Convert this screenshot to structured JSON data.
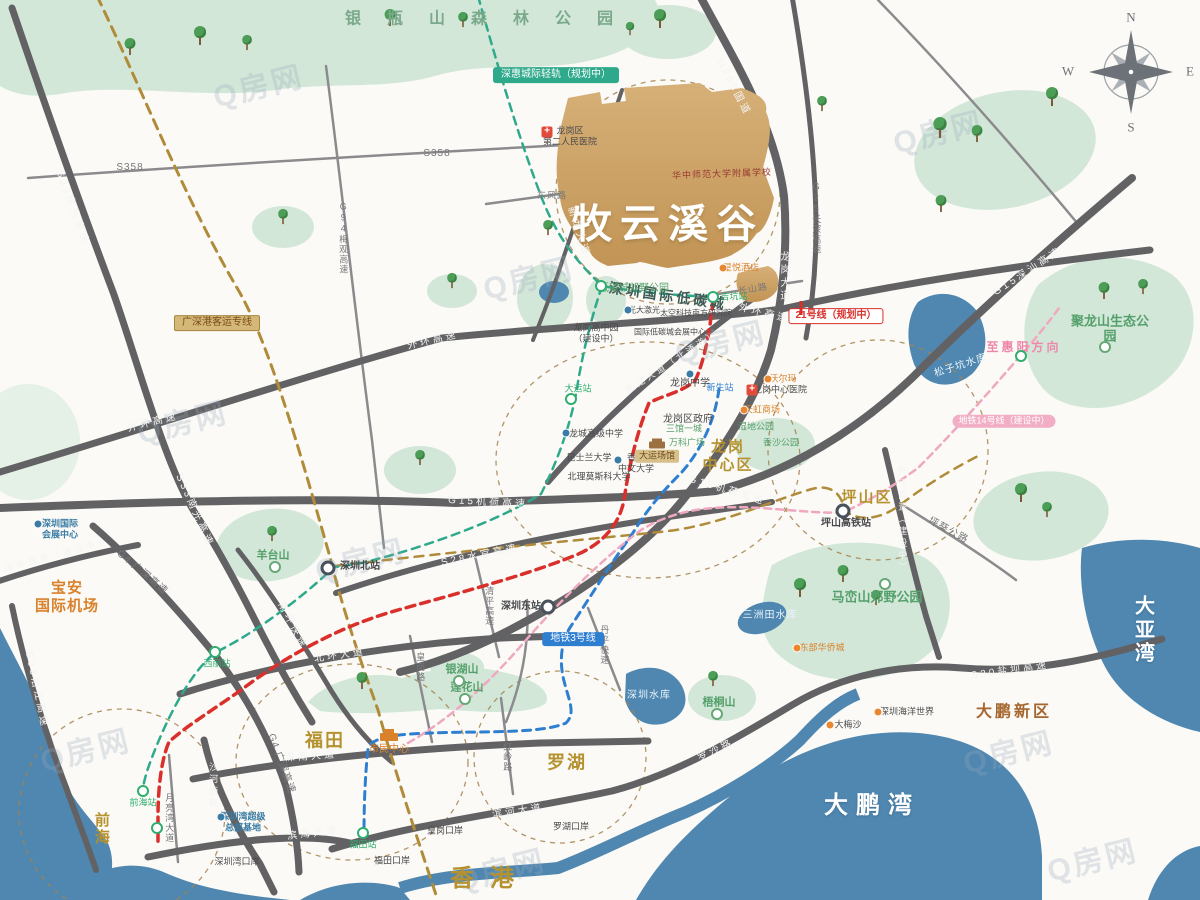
{
  "map_title": "牧云溪谷 区位示意图",
  "watermark": {
    "text": "Q房网",
    "positions": [
      [
        85,
        748
      ],
      [
        258,
        84
      ],
      [
        528,
        276
      ],
      [
        720,
        340
      ],
      [
        1008,
        750
      ],
      [
        1092,
        858
      ],
      [
        500,
        868
      ],
      [
        182,
        420
      ],
      [
        938,
        130
      ],
      [
        360,
        558
      ]
    ]
  },
  "colors": {
    "park": "#d3e7d9",
    "water": "#4f87b0",
    "road": "#626264",
    "project_tan": "#cfa76d",
    "gold_line": "#b08c3a",
    "teal_line": "#2fa98c",
    "red_line": "#d9302c",
    "blue_line": "#2f7fd1",
    "pink_line": "#f0a8c0"
  },
  "trees": [
    [
      200,
      45,
      1
    ],
    [
      247,
      52,
      0.8
    ],
    [
      390,
      27,
      0.9
    ],
    [
      463,
      29,
      0.8
    ],
    [
      660,
      28,
      1
    ],
    [
      630,
      38,
      0.7
    ],
    [
      130,
      56,
      0.9
    ],
    [
      822,
      113,
      0.8
    ],
    [
      940,
      137,
      1.1
    ],
    [
      977,
      143,
      0.9
    ],
    [
      1052,
      106,
      1
    ],
    [
      941,
      213,
      0.9
    ],
    [
      1104,
      300,
      0.9
    ],
    [
      1143,
      296,
      0.8
    ],
    [
      283,
      226,
      0.8
    ],
    [
      548,
      237,
      0.8
    ],
    [
      452,
      290,
      0.8
    ],
    [
      272,
      543,
      0.8
    ],
    [
      420,
      467,
      0.8
    ],
    [
      1021,
      502,
      1
    ],
    [
      1047,
      519,
      0.8
    ],
    [
      800,
      597,
      1
    ],
    [
      843,
      583,
      0.9
    ],
    [
      876,
      607,
      0.8
    ],
    [
      362,
      690,
      0.9
    ],
    [
      713,
      688,
      0.8
    ]
  ],
  "labels": [
    {
      "t": "forest",
      "x": 492,
      "y": 20,
      "text": "银瓶山森林公园"
    },
    {
      "t": "logo-script",
      "x": 722,
      "y": 174,
      "r": -2,
      "text": "华中师范大学附属学校"
    },
    {
      "t": "logo-name",
      "x": 668,
      "y": 225,
      "text": "牧云溪谷"
    },
    {
      "t": "lowcarbon",
      "x": 668,
      "y": 296,
      "r": 8,
      "text": "深圳国际低碳城"
    },
    {
      "t": "region-gold",
      "x": 728,
      "y": 456,
      "fs": 15,
      "text": "龙岗\n中心区"
    },
    {
      "t": "region-gold",
      "x": 867,
      "y": 498,
      "fs": 15,
      "text": "坪山区"
    },
    {
      "t": "region-gold",
      "x": 325,
      "y": 741,
      "fs": 18,
      "text": "福田"
    },
    {
      "t": "region-gold",
      "x": 567,
      "y": 763,
      "fs": 18,
      "text": "罗湖"
    },
    {
      "t": "region-gold hk",
      "x": 490,
      "y": 879,
      "fs": 24,
      "text": "香港"
    },
    {
      "t": "region-gold",
      "x": 101,
      "y": 829,
      "fs": 15,
      "v": 1,
      "text": "前海"
    },
    {
      "t": "region-white",
      "x": 872,
      "y": 806,
      "fs": 24,
      "text": "大鹏湾"
    },
    {
      "t": "region-white",
      "x": 1149,
      "y": 631,
      "fs": 20,
      "text": "大亚湾"
    },
    {
      "t": "region-brown",
      "x": 1014,
      "y": 713,
      "fs": 16,
      "text": "大鹏新区"
    },
    {
      "t": "region-orange",
      "x": 67,
      "y": 597,
      "fs": 15,
      "text": "宝安\n国际机场"
    },
    {
      "t": "i-plane",
      "x": 70,
      "y": 634
    },
    {
      "t": "park",
      "x": 1110,
      "y": 329,
      "fs": 13,
      "text": "聚龙山生态公园"
    },
    {
      "t": "i-park",
      "x": 1105,
      "y": 347
    },
    {
      "t": "park",
      "x": 877,
      "y": 597,
      "fs": 13,
      "text": "马峦山郊野公园"
    },
    {
      "t": "i-park",
      "x": 885,
      "y": 584
    },
    {
      "t": "park-sm",
      "x": 273,
      "y": 556,
      "text": "羊台山"
    },
    {
      "t": "i-park",
      "x": 275,
      "y": 567
    },
    {
      "t": "park-sm",
      "x": 467,
      "y": 688,
      "text": "莲花山"
    },
    {
      "t": "i-park",
      "x": 465,
      "y": 699
    },
    {
      "t": "park-sm",
      "x": 462,
      "y": 670,
      "text": "银湖山"
    },
    {
      "t": "i-park",
      "x": 459,
      "y": 681
    },
    {
      "t": "park-sm",
      "x": 719,
      "y": 703,
      "text": "梧桐山"
    },
    {
      "t": "i-park",
      "x": 717,
      "y": 714
    },
    {
      "t": "poi-g",
      "x": 634,
      "y": 289,
      "text": "低碳城郊野公园"
    },
    {
      "t": "i-st-g",
      "x": 601,
      "y": 286
    },
    {
      "t": "water-t",
      "x": 961,
      "y": 366,
      "r": -18,
      "text": "松子坑水库"
    },
    {
      "t": "water-t",
      "x": 770,
      "y": 616,
      "text": "三洲田水库"
    },
    {
      "t": "water-t",
      "x": 649,
      "y": 696,
      "text": "深圳水库"
    },
    {
      "t": "rd-w",
      "x": 153,
      "y": 423,
      "r": -14,
      "text": "外环高速"
    },
    {
      "t": "rd-w",
      "x": 433,
      "y": 341,
      "r": -13,
      "text": "外环高速"
    },
    {
      "t": "rd-w",
      "x": 764,
      "y": 314,
      "r": 14,
      "text": "外环高速"
    },
    {
      "t": "rd-w",
      "x": 902,
      "y": 520,
      "v": 1,
      "fs": 9,
      "text": "外环高速（建设中）"
    },
    {
      "t": "rd-w",
      "x": 72,
      "y": 208,
      "r": 70,
      "text": "S33南光高速"
    },
    {
      "t": "rd-w",
      "x": 194,
      "y": 511,
      "r": 66,
      "text": "S33南光高速"
    },
    {
      "t": "rd-w",
      "x": 36,
      "y": 690,
      "r": 78,
      "text": "S33沿江高速"
    },
    {
      "t": "rd-w",
      "x": 57,
      "y": 555,
      "r": -15,
      "fs": 9,
      "text": "深中通道（建设中）"
    },
    {
      "t": "rd-d",
      "x": 142,
      "y": 573,
      "r": 40,
      "text": "G4 广深高速"
    },
    {
      "t": "rd-d",
      "x": 281,
      "y": 764,
      "r": 70,
      "text": "G4 广深高速"
    },
    {
      "t": "rd-w",
      "x": 488,
      "y": 503,
      "r": 3,
      "text": "G15机荷高速"
    },
    {
      "t": "rd-w",
      "x": 727,
      "y": 491,
      "r": 17,
      "text": "G15机荷高速"
    },
    {
      "t": "rd-w",
      "x": 1028,
      "y": 272,
      "r": -33,
      "text": "G15深汕高速"
    },
    {
      "t": "rd-w",
      "x": 480,
      "y": 556,
      "r": -11,
      "text": "S28水官高速"
    },
    {
      "t": "rd-w",
      "x": 292,
      "y": 626,
      "r": 62,
      "text": "南坪快速"
    },
    {
      "t": "rd-w",
      "x": 340,
      "y": 656,
      "r": -8,
      "text": "北环大道"
    },
    {
      "t": "rd-w",
      "x": 311,
      "y": 757,
      "r": -4,
      "text": "深南大道"
    },
    {
      "t": "rd-w",
      "x": 518,
      "y": 812,
      "r": -8,
      "text": "滨河大道"
    },
    {
      "t": "rd-w",
      "x": 313,
      "y": 834,
      "r": -7,
      "text": "滨海大道"
    },
    {
      "t": "rd-w",
      "x": 716,
      "y": 751,
      "r": -25,
      "text": "罗沙路"
    },
    {
      "t": "rd-w",
      "x": 1010,
      "y": 671,
      "r": -8,
      "text": "S30盐坝高速"
    },
    {
      "t": "rd-w",
      "x": 672,
      "y": 362,
      "r": -33,
      "fs": 9,
      "text": "盐龙大道（北通道）"
    },
    {
      "t": "rd-w",
      "x": 783,
      "y": 277,
      "v": 1,
      "text": "龙岗大道"
    },
    {
      "t": "rd-w",
      "x": 578,
      "y": 232,
      "r": 72,
      "text": "新龙大道"
    },
    {
      "t": "rd-w",
      "x": 733,
      "y": 88,
      "r": 62,
      "text": "G205国道"
    },
    {
      "t": "rd-d",
      "x": 816,
      "y": 218,
      "v": 1,
      "fs": 9,
      "text": "G25长深高速"
    },
    {
      "t": "rd-d",
      "x": 753,
      "y": 289,
      "r": -9,
      "fs": 9,
      "text": "长山路"
    },
    {
      "t": "rd-d",
      "x": 948,
      "y": 531,
      "r": 28,
      "text": "坪葵公路"
    },
    {
      "t": "rd-d",
      "x": 169,
      "y": 818,
      "v": 1,
      "fs": 9,
      "text": "月亮湾大道"
    },
    {
      "t": "rd-w",
      "x": 213,
      "y": 786,
      "v": 1,
      "fs": 9,
      "text": "沙河西路"
    },
    {
      "t": "rd-d",
      "x": 507,
      "y": 757,
      "v": 1,
      "fs": 9,
      "text": "红岭路"
    },
    {
      "t": "rd-d",
      "x": 420,
      "y": 667,
      "v": 1,
      "fs": 9,
      "text": "皇岗路"
    },
    {
      "t": "rd-d",
      "x": 489,
      "y": 606,
      "v": 1,
      "fs": 9,
      "text": "清平高速"
    },
    {
      "t": "rd-d",
      "x": 604,
      "y": 645,
      "v": 1,
      "fs": 9,
      "text": "丹平快速"
    },
    {
      "t": "rd-d",
      "x": 130,
      "y": 168,
      "text": "S358"
    },
    {
      "t": "rd-d",
      "x": 437,
      "y": 154,
      "text": "S358"
    },
    {
      "t": "rd-d",
      "x": 343,
      "y": 238,
      "v": 1,
      "fs": 9,
      "text": "G94梅观高速"
    },
    {
      "t": "rd-d",
      "x": 552,
      "y": 196,
      "fs": 9,
      "text": "东风路"
    },
    {
      "t": "badge-teal",
      "x": 556,
      "y": 75,
      "text": "深惠城际轻轨（规划中）"
    },
    {
      "t": "badge-gold",
      "x": 217,
      "y": 323,
      "text": "广深港客运专线"
    },
    {
      "t": "badge-red",
      "x": 836,
      "y": 316,
      "text": "21号线（规划中）"
    },
    {
      "t": "i-tick",
      "x": 801,
      "y": 308
    },
    {
      "t": "badge-blue",
      "x": 573,
      "y": 639,
      "text": "地铁3号线"
    },
    {
      "t": "badge-pink",
      "x": 1004,
      "y": 421,
      "text": "地铁14号线（建设中）"
    },
    {
      "t": "pink-t",
      "x": 1024,
      "y": 347,
      "text": "至惠阳方向"
    },
    {
      "t": "i-st-d",
      "x": 328,
      "y": 568
    },
    {
      "t": "st-d",
      "x": 360,
      "y": 567,
      "text": "深圳北站"
    },
    {
      "t": "st-d",
      "x": 521,
      "y": 607,
      "text": "深圳东站"
    },
    {
      "t": "i-st-d",
      "x": 548,
      "y": 607
    },
    {
      "t": "i-st-d",
      "x": 843,
      "y": 511
    },
    {
      "t": "st-d",
      "x": 846,
      "y": 524,
      "text": "坪山高铁站"
    },
    {
      "t": "i-st-g",
      "x": 143,
      "y": 791
    },
    {
      "t": "st-g",
      "x": 143,
      "y": 803,
      "text": "前海站"
    },
    {
      "t": "i-st-g",
      "x": 157,
      "y": 828
    },
    {
      "t": "i-st-g",
      "x": 363,
      "y": 833
    },
    {
      "t": "st-g",
      "x": 363,
      "y": 845,
      "text": "福田站"
    },
    {
      "t": "i-st-g",
      "x": 215,
      "y": 652
    },
    {
      "t": "st-g",
      "x": 217,
      "y": 664,
      "text": "西丽站"
    },
    {
      "t": "i-st-g",
      "x": 713,
      "y": 297
    },
    {
      "t": "st-g",
      "x": 734,
      "y": 297,
      "text": "吉坑站"
    },
    {
      "t": "i-st-g",
      "x": 571,
      "y": 399
    },
    {
      "t": "st-g",
      "x": 578,
      "y": 389,
      "text": "大运站"
    },
    {
      "t": "i-st-g",
      "x": 1021,
      "y": 356
    },
    {
      "t": "st-b",
      "x": 720,
      "y": 388,
      "text": "新生站"
    },
    {
      "t": "poi-b",
      "x": 60,
      "y": 529,
      "fs": 9,
      "text": "深圳国际\n会展中心"
    },
    {
      "t": "i-dot-b",
      "x": 38,
      "y": 524
    },
    {
      "t": "poi-b",
      "x": 243,
      "y": 822,
      "fs": 9,
      "text": "深圳湾超级\n总部基地"
    },
    {
      "t": "i-dot-b",
      "x": 221,
      "y": 817
    },
    {
      "t": "poi-o",
      "x": 389,
      "y": 750,
      "text": "市民中心"
    },
    {
      "t": "i-bldg-o",
      "x": 389,
      "y": 737
    },
    {
      "t": "poi",
      "x": 688,
      "y": 420,
      "text": "龙岗区政府"
    },
    {
      "t": "i-star",
      "x": 688,
      "y": 408
    },
    {
      "t": "poi",
      "x": 690,
      "y": 384,
      "text": "龙岗中学"
    },
    {
      "t": "i-dot-b",
      "x": 690,
      "y": 374
    },
    {
      "t": "poi",
      "x": 596,
      "y": 434,
      "fs": 9,
      "text": "龙城高级中学"
    },
    {
      "t": "i-dot-b",
      "x": 566,
      "y": 433
    },
    {
      "t": "poi",
      "x": 636,
      "y": 463,
      "fs": 9,
      "text": "香港\n中文大学"
    },
    {
      "t": "i-dot-b",
      "x": 618,
      "y": 460
    },
    {
      "t": "poi",
      "x": 599,
      "y": 477,
      "fs": 9,
      "text": "北理莫斯科大学"
    },
    {
      "t": "poi",
      "x": 589,
      "y": 458,
      "fs": 9,
      "text": "昆士兰大学"
    },
    {
      "t": "poi",
      "x": 596,
      "y": 333,
      "fs": 9,
      "text": "龙岗高中园\n（建设中）"
    },
    {
      "t": "poi",
      "x": 570,
      "y": 136,
      "fs": 9,
      "text": "龙岗区\n第二人民医院"
    },
    {
      "t": "i-cross",
      "x": 547,
      "y": 132
    },
    {
      "t": "poi",
      "x": 780,
      "y": 390,
      "fs": 9,
      "text": "龙岗中心医院"
    },
    {
      "t": "i-cross",
      "x": 752,
      "y": 390
    },
    {
      "t": "poi-g",
      "x": 684,
      "y": 429,
      "fs": 9,
      "text": "三馆一城"
    },
    {
      "t": "poi-g",
      "x": 687,
      "y": 443,
      "fs": 9,
      "text": "万科广场"
    },
    {
      "t": "poi-o",
      "x": 783,
      "y": 379,
      "fs": 9,
      "text": "沃尔玛"
    },
    {
      "t": "i-dot-o",
      "x": 768,
      "y": 379
    },
    {
      "t": "poi-o",
      "x": 762,
      "y": 410,
      "fs": 9,
      "text": "天虹商场"
    },
    {
      "t": "i-dot-o",
      "x": 744,
      "y": 410
    },
    {
      "t": "poi-g",
      "x": 756,
      "y": 427,
      "fs": 9,
      "text": "湿地公园"
    },
    {
      "t": "poi-g",
      "x": 781,
      "y": 443,
      "fs": 9,
      "text": "香沙公园"
    },
    {
      "t": "tag-tan",
      "x": 657,
      "y": 456,
      "text": "大运场馆"
    },
    {
      "t": "i-bldg-br",
      "x": 657,
      "y": 445
    },
    {
      "t": "poi-o",
      "x": 741,
      "y": 268,
      "fs": 9,
      "text": "星悦酒店"
    },
    {
      "t": "i-dot-o",
      "x": 723,
      "y": 268
    },
    {
      "t": "poi",
      "x": 907,
      "y": 712,
      "fs": 9,
      "text": "深圳海洋世界"
    },
    {
      "t": "i-dot-o",
      "x": 878,
      "y": 712
    },
    {
      "t": "poi",
      "x": 848,
      "y": 725,
      "fs": 9,
      "text": "大梅沙"
    },
    {
      "t": "i-dot-o",
      "x": 830,
      "y": 725
    },
    {
      "t": "poi-o",
      "x": 822,
      "y": 648,
      "fs": 9,
      "text": "东部华侨城"
    },
    {
      "t": "i-dot-o",
      "x": 797,
      "y": 648
    },
    {
      "t": "poi",
      "x": 571,
      "y": 827,
      "fs": 9,
      "text": "罗湖口岸"
    },
    {
      "t": "i-star",
      "x": 591,
      "y": 826
    },
    {
      "t": "poi",
      "x": 445,
      "y": 831,
      "fs": 9,
      "text": "皇岗口岸"
    },
    {
      "t": "i-star",
      "x": 442,
      "y": 841
    },
    {
      "t": "poi",
      "x": 392,
      "y": 861,
      "fs": 9,
      "text": "福田口岸"
    },
    {
      "t": "i-star",
      "x": 411,
      "y": 861
    },
    {
      "t": "poi",
      "x": 237,
      "y": 862,
      "fs": 9,
      "text": "深圳湾口岸"
    },
    {
      "t": "i-star",
      "x": 216,
      "y": 862
    },
    {
      "t": "poi",
      "x": 644,
      "y": 310,
      "fs": 8,
      "text": "光大激光"
    },
    {
      "t": "i-dot-b",
      "x": 628,
      "y": 310
    },
    {
      "t": "poi",
      "x": 696,
      "y": 313,
      "fs": 8,
      "text": "太空科技南方研究院"
    },
    {
      "t": "poi",
      "x": 670,
      "y": 332,
      "fs": 8,
      "text": "国际低碳城会展中心"
    },
    {
      "t": "compass",
      "x": 1131,
      "y": 17,
      "text": "N"
    },
    {
      "t": "compass",
      "x": 1190,
      "y": 71,
      "text": "E"
    },
    {
      "t": "compass",
      "x": 1131,
      "y": 127,
      "text": "S"
    },
    {
      "t": "compass",
      "x": 1068,
      "y": 71,
      "text": "W"
    }
  ]
}
